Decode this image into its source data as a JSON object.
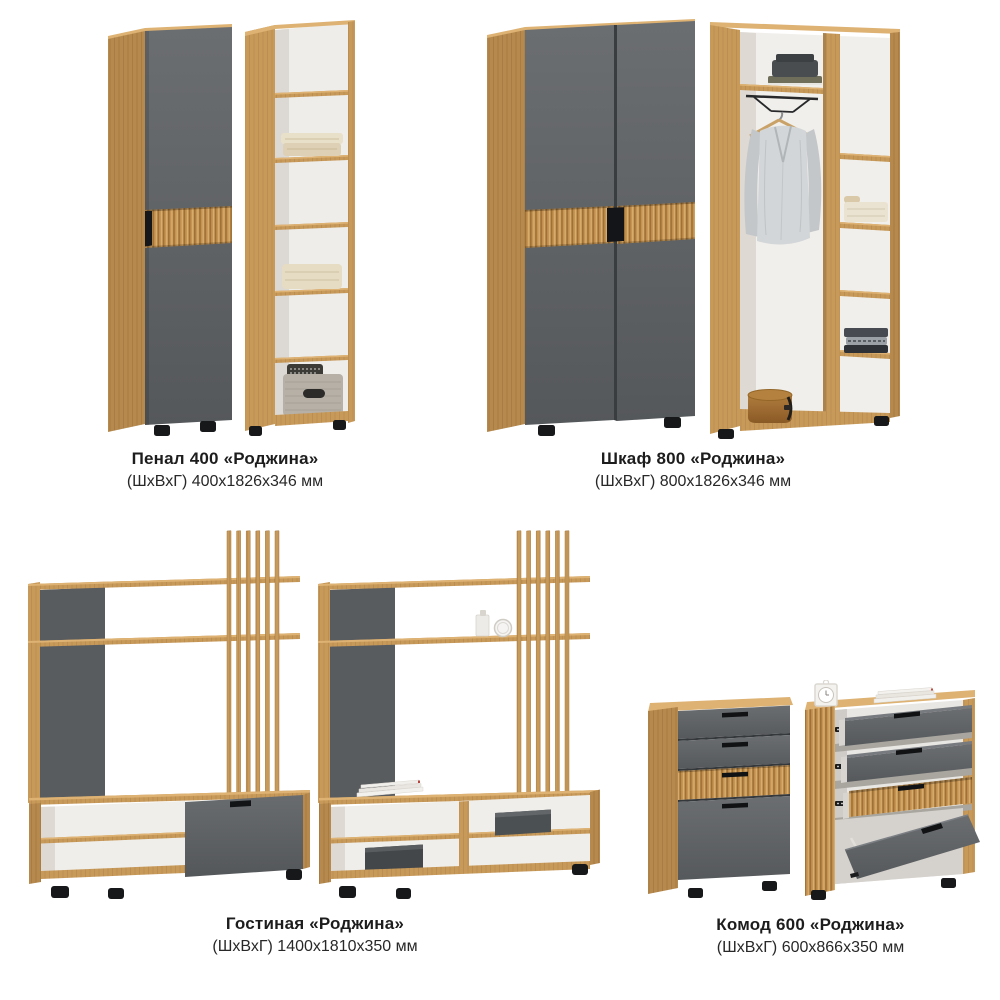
{
  "page": {
    "background_color": "#ffffff"
  },
  "colors": {
    "wood": "#c89a5a",
    "wood_dark": "#b5854a",
    "wood_light_top": "#ddb273",
    "graphite_front": "#5d6064",
    "interior_white": "#f0eeea",
    "feet_black": "#17181a",
    "text": "#1d1d1d"
  },
  "products": [
    {
      "title": "Пенал 400 «Роджина»",
      "dimensions": "(ШхВхГ) 400х1826х346 мм"
    },
    {
      "title": "Шкаф 800 «Роджина»",
      "dimensions": "(ШхВхГ) 800х1826х346 мм"
    },
    {
      "title": "Гостиная «Роджина»",
      "dimensions": "(ШхВхГ) 1400х1810х350 мм"
    },
    {
      "title": "Комод 600 «Роджина»",
      "dimensions": "(ШхВхГ) 600х866х350 мм"
    }
  ]
}
